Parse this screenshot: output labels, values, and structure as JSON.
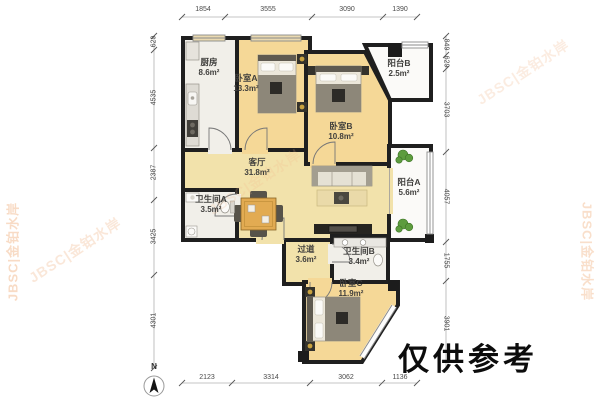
{
  "rooms": {
    "kitchen": {
      "name": "厨房",
      "area": "8.6m²"
    },
    "bedroom_a": {
      "name": "卧室A",
      "area": "13.3m²"
    },
    "balcony_b": {
      "name": "阳台B",
      "area": "2.5m²"
    },
    "bedroom_b": {
      "name": "卧室B",
      "area": "10.8m²"
    },
    "living": {
      "name": "客厅",
      "area": "31.8m²"
    },
    "balcony_a": {
      "name": "阳台A",
      "area": "5.6m²"
    },
    "bathroom_a": {
      "name": "卫生间A",
      "area": "3.5m²"
    },
    "hallway": {
      "name": "过道",
      "area": "3.6m²"
    },
    "bathroom_b": {
      "name": "卫生间B",
      "area": "3.4m²"
    },
    "bedroom_c": {
      "name": "卧室C",
      "area": "11.9m²"
    }
  },
  "dimensions": {
    "top": [
      "1854",
      "3555",
      "3090",
      "1390"
    ],
    "bottom": [
      "2123",
      "3314",
      "3062",
      "1136"
    ],
    "left": [
      "629",
      "4535",
      "2387",
      "3425",
      "4301"
    ],
    "right": [
      "849",
      "629",
      "3703",
      "4057",
      "1755",
      "3901"
    ]
  },
  "compass": {
    "label": "N"
  },
  "watermark": {
    "text": "JBSC|金铂水岸"
  },
  "disclaimer": {
    "text": "仅供参考"
  },
  "colors": {
    "wall": "#1f1f1f",
    "floor_bedroom": "#f5d897",
    "floor_living": "#f2e2ab",
    "floor_wet": "#f1efe9",
    "table_wood": "#e2ab52",
    "plant": "#5d9c3e",
    "watermark": "#f2b98d"
  }
}
